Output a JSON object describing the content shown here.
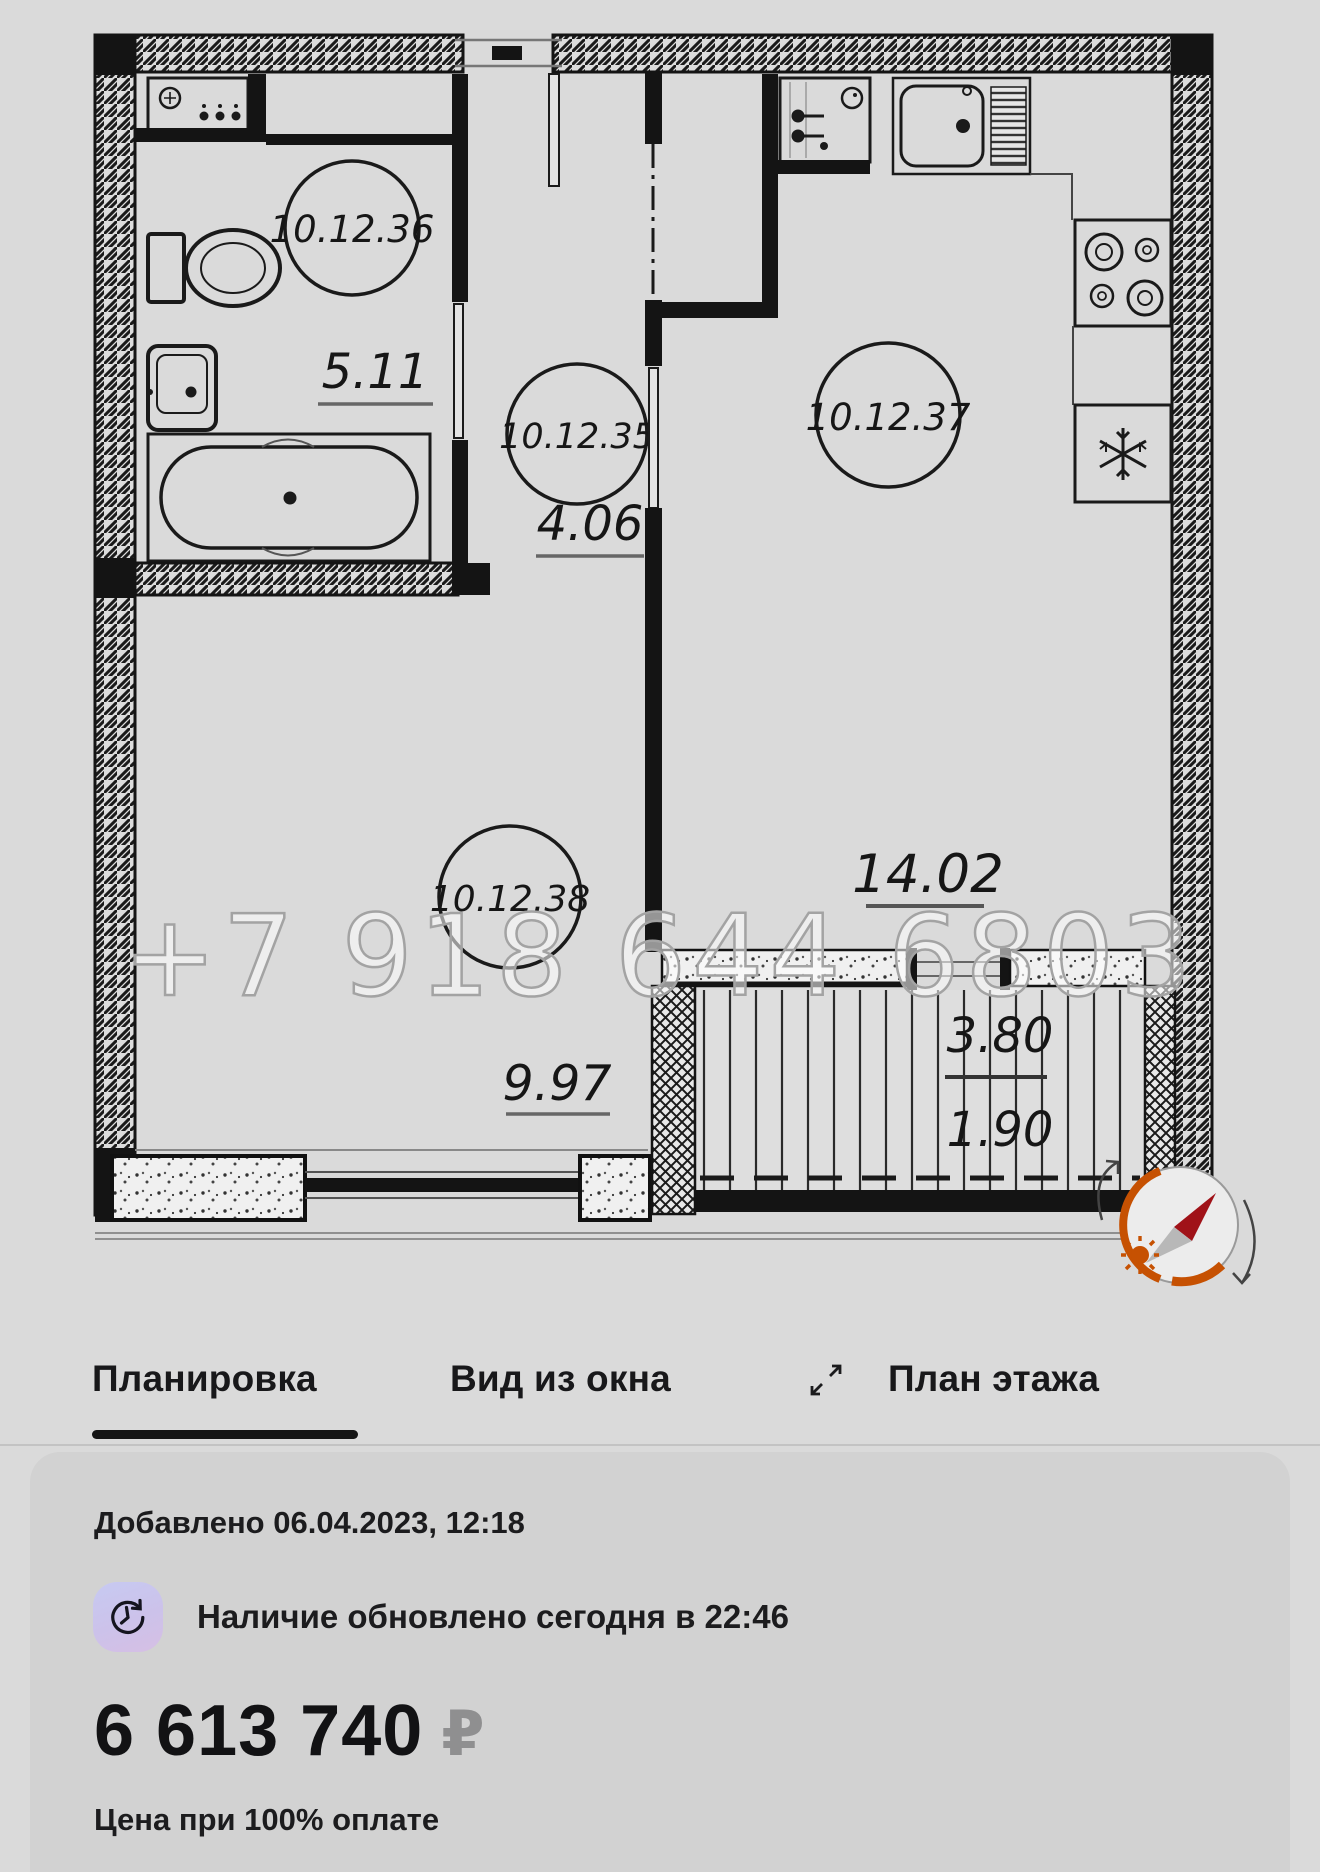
{
  "floor_plan": {
    "watermark": "+7 918 644 6803",
    "rooms": [
      {
        "number": "10.12.36",
        "area": "5.11",
        "type": "bathroom"
      },
      {
        "number": "10.12.35",
        "area": "4.06",
        "type": "hallway"
      },
      {
        "number": "10.12.37",
        "area": "14.02",
        "type": "kitchen-living"
      },
      {
        "number": "10.12.38",
        "area": "9.97",
        "type": "room"
      }
    ],
    "balcony": {
      "dim_top": "3.80",
      "dim_bottom": "1.90"
    }
  },
  "tabs": [
    {
      "label": "Планировка",
      "active": true
    },
    {
      "label": "Вид из окна",
      "active": false
    },
    {
      "label": "План этажа",
      "active": false
    }
  ],
  "listing": {
    "added": "Добавлено 06.04.2023, 12:18",
    "availability": "Наличие обновлено сегодня в 22:46",
    "price": "6 613 740",
    "currency": "₽",
    "price_note": "Цена при 100% оплате"
  },
  "colors": {
    "compass_orange": "#c65102",
    "needle_red": "#a01218",
    "icon_lavender": "#c7caf2",
    "active_tab_underline": "#141414"
  }
}
